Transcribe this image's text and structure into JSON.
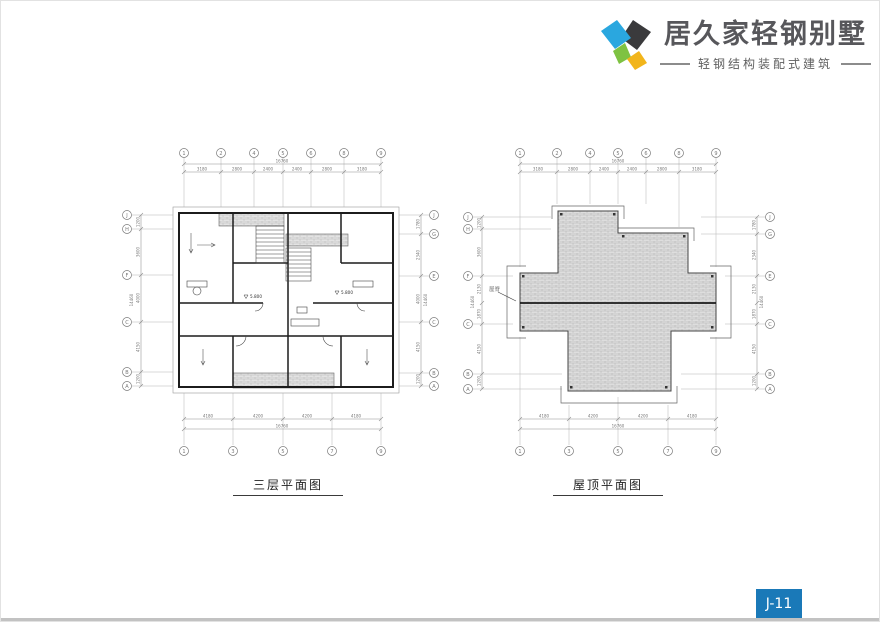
{
  "header": {
    "logo_title": "居久家轻钢别墅",
    "logo_subtitle": "轻钢结构装配式建筑",
    "logo_colors": {
      "blue": "#2aa7df",
      "dark": "#3a3a3c",
      "green": "#7ec242",
      "yellow": "#f2b51b"
    }
  },
  "page_badge": {
    "label": "J-11",
    "color": "#1a79b8"
  },
  "plans": {
    "floor3": {
      "title": "三层平面图",
      "total_width": "16760",
      "total_height": "14460",
      "top_dims": [
        "3180",
        "2800",
        "2400",
        "2400",
        "2800",
        "3180"
      ],
      "bottom_dims": [
        "4180",
        "4200",
        "4200",
        "4180"
      ],
      "left_dims": [
        "1200",
        "3600",
        "4000",
        "4150",
        "1200"
      ],
      "right_dims": [
        "1780",
        "2340",
        "4000",
        "4150",
        "1200"
      ],
      "col_labels_top": [
        "1",
        "2",
        "4",
        "5",
        "6",
        "8",
        "9"
      ],
      "col_labels_bottom": [
        "1",
        "3",
        "5",
        "7",
        "9"
      ],
      "row_labels_left": [
        "J",
        "H",
        "F",
        "C",
        "B",
        "A"
      ],
      "row_labels_right": [
        "J",
        "G",
        "E",
        "C",
        "B",
        "A"
      ],
      "elevations": [
        "5.800",
        "5.800"
      ]
    },
    "roof": {
      "title": "屋顶平面图",
      "total_width": "16760",
      "total_height": "14460",
      "top_dims": [
        "3180",
        "2800",
        "2400",
        "2400",
        "2800",
        "3180"
      ],
      "bottom_dims": [
        "4180",
        "4200",
        "4200",
        "4180"
      ],
      "left_dims": [
        "1200",
        "3600",
        "2130",
        "1870",
        "4150",
        "1200"
      ],
      "right_dims": [
        "1780",
        "2340",
        "2130",
        "1870",
        "4150",
        "1200"
      ],
      "col_labels_top": [
        "1",
        "2",
        "4",
        "5",
        "6",
        "8",
        "9"
      ],
      "col_labels_bottom": [
        "1",
        "3",
        "5",
        "7",
        "9"
      ],
      "row_labels_left": [
        "J",
        "H",
        "F",
        "C",
        "B",
        "A"
      ],
      "row_labels_right": [
        "J",
        "G",
        "E",
        "C",
        "B",
        "A"
      ],
      "ridge_label": "屋脊"
    }
  }
}
